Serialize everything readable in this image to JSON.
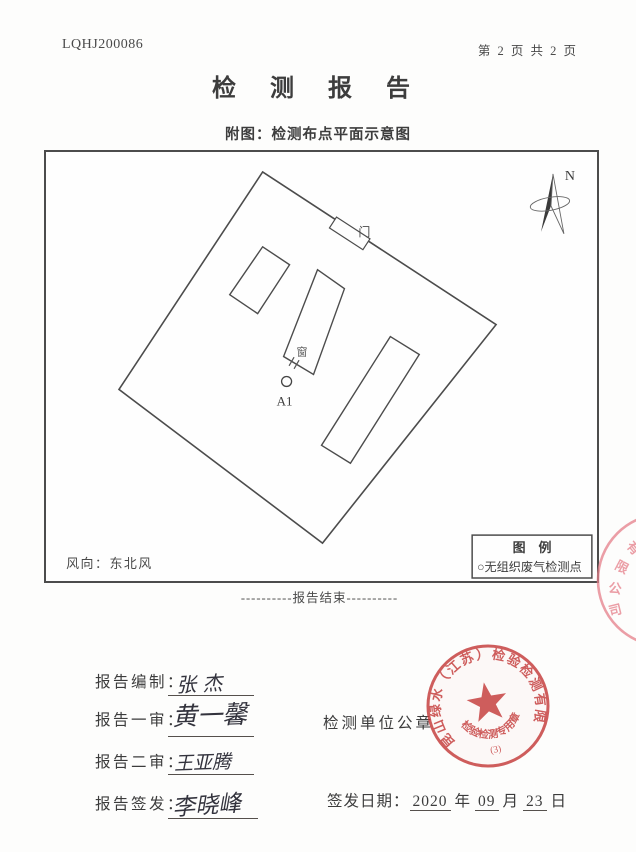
{
  "header": {
    "report_no": "LQHJ200086",
    "page_info": "第 2 页 共 2 页",
    "title": "检 测 报 告",
    "subtitle": "附图：检测布点平面示意图"
  },
  "diagram": {
    "north_label": "N",
    "door_label": "门",
    "window_label": "窗",
    "sample_point_label": "A1",
    "wind_direction": "风向：东北风",
    "legend_title": "图　例",
    "legend_item": "○无组织废气检测点"
  },
  "report_end": "----------报告结束----------",
  "signatures": {
    "prepared_label": "报告编制：",
    "prepared_name": "张 杰",
    "first_review_label": "报告一审：",
    "first_review_name": "黄一馨",
    "second_review_label": "报告二审：",
    "second_review_name": "王亚腾",
    "issued_label": "报告签发：",
    "issued_name": "李晓峰"
  },
  "seal_section": {
    "unit_seal_label": "检测单位公章",
    "issue_date_label": "签发日期：",
    "date_year": "2020",
    "year_suffix": "年",
    "date_month": "09",
    "month_suffix": "月",
    "date_day": "23",
    "day_suffix": "日",
    "seal": {
      "company": "昆山绿水（江苏）检验检测有限公司",
      "type_text": "检验检测专用章",
      "number": "(3)",
      "color": "#c43a3a"
    },
    "edge_seal_chars": [
      "有",
      "限",
      "公",
      "司"
    ]
  }
}
